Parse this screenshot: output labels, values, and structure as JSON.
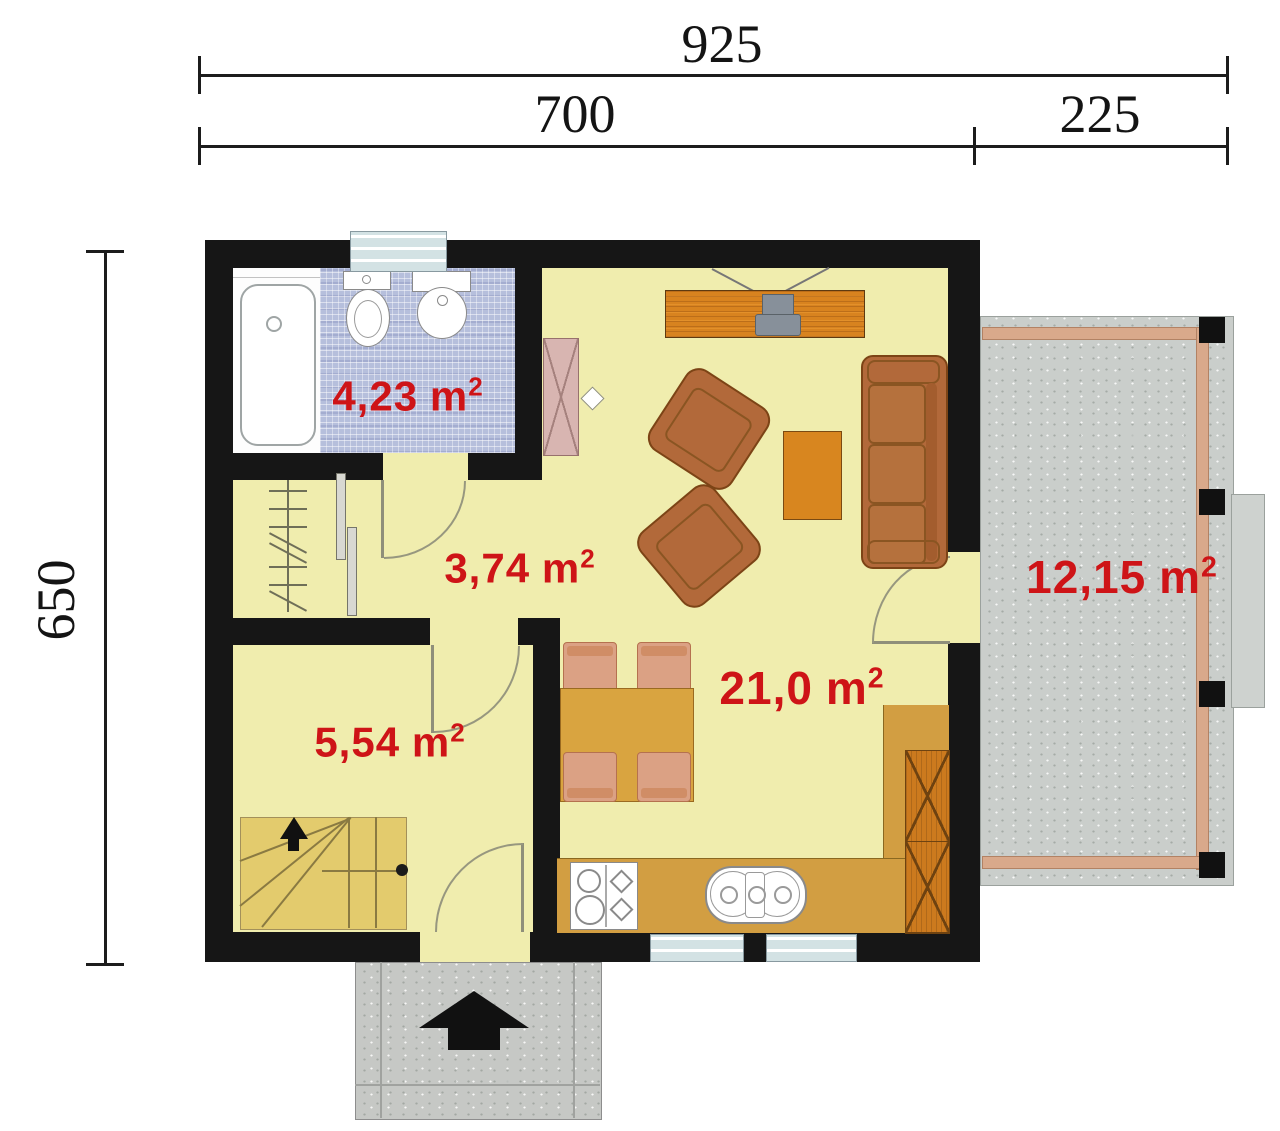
{
  "dimension_labels": {
    "overall_width": "925",
    "house_width": "700",
    "terrace_width": "225",
    "house_depth": "650"
  },
  "rooms": [
    {
      "name": "bathroom",
      "area": "4,23",
      "unit": "m",
      "exponent": "2"
    },
    {
      "name": "hallway",
      "area": "3,74",
      "unit": "m",
      "exponent": "2"
    },
    {
      "name": "stair-room",
      "area": "5,54",
      "unit": "m",
      "exponent": "2"
    },
    {
      "name": "living-kitchen",
      "area": "21,0",
      "unit": "m",
      "exponent": "2"
    },
    {
      "name": "terrace",
      "area": "12,15",
      "unit": "m",
      "exponent": "2"
    }
  ],
  "colors": {
    "area_label_red": "#ce1417",
    "wall_black": "#161616",
    "floor_yellow": "#f0edae",
    "stairs_yellow": "#e3cb6d",
    "tile_blue": "#b6bfdc",
    "terrace_gray": "#cacecb",
    "wood_orange": "#d8831f",
    "counter_ochre": "#d29e42",
    "upholstery_brown": "#b2693a",
    "deck_strip_tan": "#d9a98b"
  }
}
